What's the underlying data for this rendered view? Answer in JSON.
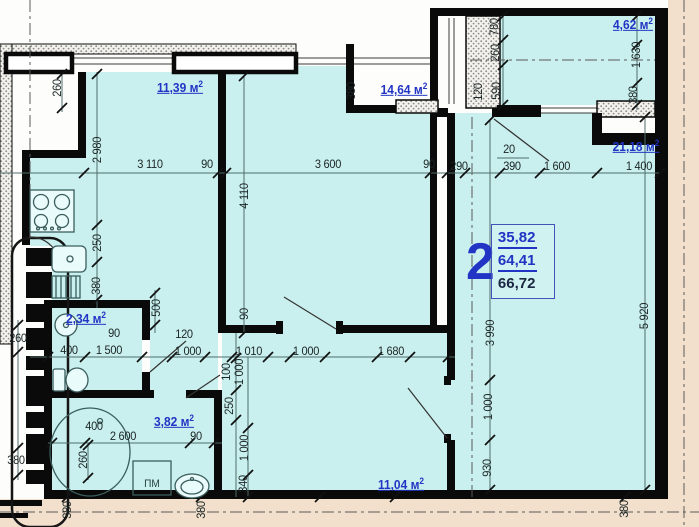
{
  "plan": {
    "stamp": {
      "rooms": "2",
      "living": "35,82",
      "secondary": "64,41",
      "total": "66,72"
    },
    "rooms": [
      {
        "name": "kitchen",
        "area": "11,39",
        "unit_base": "м",
        "unit_exp": "2",
        "x": 180,
        "y": 87
      },
      {
        "name": "room-middle",
        "area": "14,64",
        "unit_base": "м",
        "unit_exp": "2",
        "x": 404,
        "y": 89
      },
      {
        "name": "loggia",
        "area": "4,62",
        "unit_base": "м",
        "unit_exp": "2",
        "x": 633,
        "y": 24
      },
      {
        "name": "room-right",
        "area": "21,18",
        "unit_base": "м",
        "unit_exp": "2",
        "x": 636,
        "y": 146
      },
      {
        "name": "wc",
        "area": "2,34",
        "unit_base": "м",
        "unit_exp": "2",
        "x": 86,
        "y": 318
      },
      {
        "name": "bathroom",
        "area": "3,82",
        "unit_base": "м",
        "unit_exp": "2",
        "x": 174,
        "y": 421
      },
      {
        "name": "hall",
        "area": "11,04",
        "unit_base": "м",
        "unit_exp": "2",
        "x": 401,
        "y": 484
      }
    ],
    "dimensions": [
      {
        "text": "3 110",
        "x": 150,
        "y": 164,
        "rot": 0
      },
      {
        "text": "90",
        "x": 207,
        "y": 164,
        "rot": 0
      },
      {
        "text": "3 600",
        "x": 328,
        "y": 164,
        "rot": 0
      },
      {
        "text": "90",
        "x": 429,
        "y": 164,
        "rot": 0
      },
      {
        "text": "290",
        "x": 459,
        "y": 166,
        "rot": 0
      },
      {
        "text": "20",
        "x": 509,
        "y": 149,
        "rot": 0
      },
      {
        "text": "390",
        "x": 512,
        "y": 166,
        "rot": 0
      },
      {
        "text": "1 600",
        "x": 557,
        "y": 166,
        "rot": 0
      },
      {
        "text": "1 400",
        "x": 639,
        "y": 166,
        "rot": 0
      },
      {
        "text": "260",
        "x": 57,
        "y": 88,
        "rot": 90
      },
      {
        "text": "2 980",
        "x": 97,
        "y": 150,
        "rot": 90
      },
      {
        "text": "250",
        "x": 97,
        "y": 243,
        "rot": 90
      },
      {
        "text": "380",
        "x": 96,
        "y": 286,
        "rot": 90
      },
      {
        "text": "4 110",
        "x": 244,
        "y": 196,
        "rot": 90
      },
      {
        "text": "380",
        "x": 351,
        "y": 91,
        "rot": 90
      },
      {
        "text": "780",
        "x": 494,
        "y": 27,
        "rot": 90
      },
      {
        "text": "260",
        "x": 495,
        "y": 53,
        "rot": 90
      },
      {
        "text": "120",
        "x": 478,
        "y": 92,
        "rot": 90
      },
      {
        "text": "590",
        "x": 496,
        "y": 91,
        "rot": 90
      },
      {
        "text": "1 630",
        "x": 636,
        "y": 55,
        "rot": 90
      },
      {
        "text": "380",
        "x": 633,
        "y": 95,
        "rot": 90
      },
      {
        "text": "3 990",
        "x": 490,
        "y": 333,
        "rot": 90
      },
      {
        "text": "5 920",
        "x": 644,
        "y": 316,
        "rot": 90
      },
      {
        "text": "1 000",
        "x": 488,
        "y": 407,
        "rot": 90
      },
      {
        "text": "930",
        "x": 487,
        "y": 468,
        "rot": 90
      },
      {
        "text": "500",
        "x": 156,
        "y": 308,
        "rot": 90
      },
      {
        "text": "90",
        "x": 114,
        "y": 333,
        "rot": 0
      },
      {
        "text": "120",
        "x": 184,
        "y": 334,
        "rot": 0
      },
      {
        "text": "400",
        "x": 69,
        "y": 350,
        "rot": 0
      },
      {
        "text": "1 500",
        "x": 109,
        "y": 350,
        "rot": 0
      },
      {
        "text": "1 000",
        "x": 188,
        "y": 351,
        "rot": 0
      },
      {
        "text": "1 010",
        "x": 249,
        "y": 351,
        "rot": 0
      },
      {
        "text": "1 000",
        "x": 306,
        "y": 351,
        "rot": 0
      },
      {
        "text": "1 680",
        "x": 391,
        "y": 351,
        "rot": 0
      },
      {
        "text": "90",
        "x": 244,
        "y": 314,
        "rot": 90
      },
      {
        "text": "100",
        "x": 226,
        "y": 372,
        "rot": 90
      },
      {
        "text": "1 000",
        "x": 239,
        "y": 372,
        "rot": 90
      },
      {
        "text": "250",
        "x": 229,
        "y": 406,
        "rot": 90
      },
      {
        "text": "1 000",
        "x": 244,
        "y": 448,
        "rot": 90
      },
      {
        "text": "340",
        "x": 243,
        "y": 484,
        "rot": 90
      },
      {
        "text": "400",
        "x": 94,
        "y": 426,
        "rot": 0
      },
      {
        "text": "2 600",
        "x": 123,
        "y": 436,
        "rot": 0
      },
      {
        "text": "90",
        "x": 196,
        "y": 436,
        "rot": 0
      },
      {
        "text": "260",
        "x": 83,
        "y": 460,
        "rot": 90
      },
      {
        "text": "260",
        "x": 18,
        "y": 338,
        "rot": 0
      },
      {
        "text": "380",
        "x": 16,
        "y": 460,
        "rot": 0
      },
      {
        "text": "380",
        "x": 67,
        "y": 510,
        "rot": 90
      },
      {
        "text": "380",
        "x": 201,
        "y": 510,
        "rot": 90
      },
      {
        "text": "380",
        "x": 624,
        "y": 509,
        "rot": 90
      }
    ],
    "annotations": [
      {
        "text": "ПМ",
        "x": 152,
        "y": 484
      }
    ],
    "colors": {
      "room_fill": "#c9f0ee",
      "wall": "#0a0a0a",
      "label_blue": "#2134c4",
      "total_dark": "#1b2742",
      "outside_beige": "#f2e0cc",
      "dim_text": "#1c2626"
    }
  }
}
